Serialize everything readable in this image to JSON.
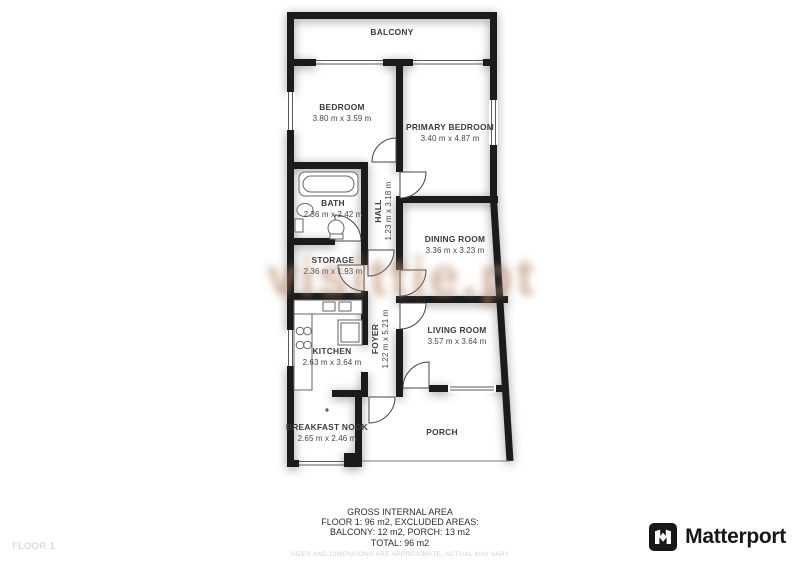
{
  "watermark": {
    "text": "visittie.pt",
    "color": "#ba8b6c"
  },
  "floor_plan": {
    "rooms": {
      "balcony": {
        "name": "BALCONY",
        "dims": ""
      },
      "bedroom": {
        "name": "BEDROOM",
        "dims": "3.80 m x 3.59 m"
      },
      "primary_bedroom": {
        "name": "PRIMARY BEDROOM",
        "dims": "3.40 m x 4.87 m"
      },
      "bath": {
        "name": "BATH",
        "dims": "2.36 m x 2.42 m"
      },
      "hall": {
        "name": "HALL",
        "dims": "1.23 m x 3.18 m"
      },
      "storage": {
        "name": "STORAGE",
        "dims": "2.36 m x 1.93 m"
      },
      "dining_room": {
        "name": "DINING ROOM",
        "dims": "3.36 m x 3.23 m"
      },
      "kitchen": {
        "name": "KITCHEN",
        "dims": "2.63 m x 3.64 m"
      },
      "foyer": {
        "name": "FOYER",
        "dims": "1.22 m x 5.21 m"
      },
      "living_room": {
        "name": "LIVING ROOM",
        "dims": "3.57 m x 3.64 m"
      },
      "breakfast_nook": {
        "name": "BREAKFAST NOOK",
        "dims": "2.65 m x 2.46 m"
      },
      "porch": {
        "name": "PORCH",
        "dims": ""
      }
    }
  },
  "footer": {
    "floor_label": "FLOOR 1",
    "summary": {
      "title": "GROSS INTERNAL AREA",
      "line2": "FLOOR 1: 96 m2, EXCLUDED AREAS:",
      "line3": "BALCONY: 12 m2, PORCH: 13 m2",
      "line4": "TOTAL: 96 m2",
      "disclaimer": "SIZES AND DIMENSIONS ARE APPROXIMATE, ACTUAL MAY VARY"
    },
    "brand": {
      "name": "Matterport"
    }
  }
}
